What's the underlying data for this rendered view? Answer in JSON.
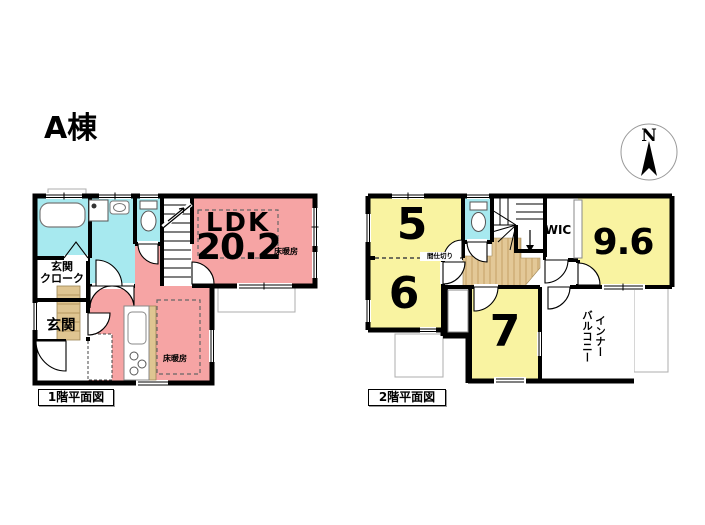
{
  "title": "A棟",
  "compass_label": "N",
  "colors": {
    "ldk_pink": "#F6A4A4",
    "wet_area_cyan": "#A7E9EF",
    "room_yellow": "#F9F3A1",
    "wood_tan": "#DFC591",
    "wall_black": "#000000",
    "eave_gray": "#ADADAD"
  },
  "floor1": {
    "caption": "1階平面図",
    "ldk_name": "LDK",
    "ldk_size": "20.2",
    "floor_heating_ldk": "床暖房",
    "floor_heating_kitchen": "床暖房",
    "entrance_cloak": "玄関\nクローク",
    "entrance": "玄関"
  },
  "floor2": {
    "caption": "2階平面図",
    "room5": "5",
    "room6": "6",
    "room7": "7",
    "room96": "9.6",
    "wic": "WIC",
    "inner_balcony": "インナー\nバルコニー",
    "partition": "間仕切り"
  }
}
